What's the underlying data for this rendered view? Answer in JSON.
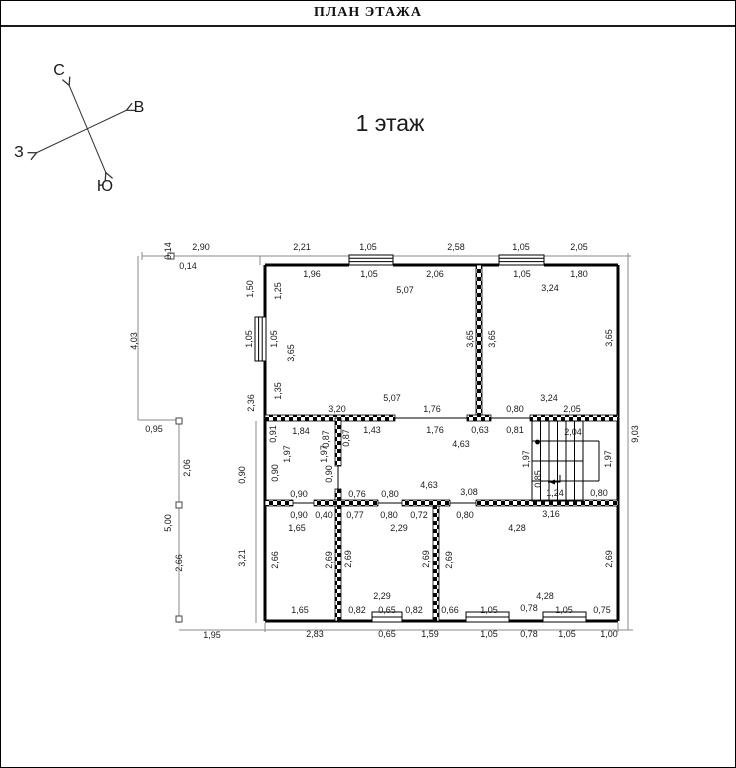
{
  "page": {
    "title": "ПЛАН ЭТАЖА",
    "floor_label": "1 этаж"
  },
  "compass": {
    "north": "С",
    "east": "В",
    "west": "З",
    "south": "Ю"
  },
  "colors": {
    "ink": "#000000",
    "dim_text": "#1a1a1a",
    "aux_line": "#888888"
  },
  "plan": {
    "units": "meters",
    "labels": [
      {
        "t": "2,90",
        "x": 200,
        "y": 246
      },
      {
        "t": "2,21",
        "x": 301,
        "y": 246
      },
      {
        "t": "1,05",
        "x": 367,
        "y": 246
      },
      {
        "t": "2,58",
        "x": 455,
        "y": 246
      },
      {
        "t": "1,05",
        "x": 520,
        "y": 246
      },
      {
        "t": "2,05",
        "x": 578,
        "y": 246
      },
      {
        "t": "0,14",
        "x": 167,
        "y": 250,
        "r": 1
      },
      {
        "t": "0,14",
        "x": 187,
        "y": 265
      },
      {
        "t": "1,96",
        "x": 311,
        "y": 273
      },
      {
        "t": "1,05",
        "x": 368,
        "y": 273
      },
      {
        "t": "2,06",
        "x": 434,
        "y": 273
      },
      {
        "t": "1,05",
        "x": 521,
        "y": 273
      },
      {
        "t": "1,80",
        "x": 578,
        "y": 273
      },
      {
        "t": "3,24",
        "x": 549,
        "y": 287
      },
      {
        "t": "5,07",
        "x": 404,
        "y": 289
      },
      {
        "t": "4,03",
        "x": 133,
        "y": 340,
        "r": 1
      },
      {
        "t": "1,50",
        "x": 249,
        "y": 288,
        "r": 1
      },
      {
        "t": "1,25",
        "x": 277,
        "y": 290,
        "r": 1
      },
      {
        "t": "1,05",
        "x": 248,
        "y": 338,
        "r": 1
      },
      {
        "t": "1,05",
        "x": 273,
        "y": 338,
        "r": 1
      },
      {
        "t": "3,65",
        "x": 290,
        "y": 352,
        "r": 1
      },
      {
        "t": "1,35",
        "x": 277,
        "y": 390,
        "r": 1
      },
      {
        "t": "2,36",
        "x": 250,
        "y": 402,
        "r": 1
      },
      {
        "t": "3,65",
        "x": 469,
        "y": 338,
        "r": 1
      },
      {
        "t": "3,65",
        "x": 491,
        "y": 338,
        "r": 1
      },
      {
        "t": "3,65",
        "x": 608,
        "y": 337,
        "r": 1
      },
      {
        "t": "0,95",
        "x": 153,
        "y": 428
      },
      {
        "t": "5,07",
        "x": 391,
        "y": 397
      },
      {
        "t": "3,24",
        "x": 548,
        "y": 397
      },
      {
        "t": "3,20",
        "x": 336,
        "y": 408
      },
      {
        "t": "1,76",
        "x": 431,
        "y": 408
      },
      {
        "t": "0,80",
        "x": 514,
        "y": 408
      },
      {
        "t": "2,05",
        "x": 571,
        "y": 408
      },
      {
        "t": "1,84",
        "x": 300,
        "y": 430
      },
      {
        "t": "1,43",
        "x": 371,
        "y": 429
      },
      {
        "t": "1,76",
        "x": 434,
        "y": 429
      },
      {
        "t": "0,63",
        "x": 479,
        "y": 429
      },
      {
        "t": "0,81",
        "x": 514,
        "y": 429
      },
      {
        "t": "2,04",
        "x": 572,
        "y": 431
      },
      {
        "t": "0,91",
        "x": 272,
        "y": 433,
        "r": 1
      },
      {
        "t": "0,87",
        "x": 325,
        "y": 438,
        "r": 1
      },
      {
        "t": "0,87",
        "x": 345,
        "y": 437,
        "r": 1
      },
      {
        "t": "1,97",
        "x": 286,
        "y": 453,
        "r": 1
      },
      {
        "t": "1,97",
        "x": 323,
        "y": 453,
        "r": 1
      },
      {
        "t": "4,63",
        "x": 460,
        "y": 443
      },
      {
        "t": "0,90",
        "x": 241,
        "y": 474,
        "r": 1
      },
      {
        "t": "0,90",
        "x": 274,
        "y": 472,
        "r": 1
      },
      {
        "t": "0,90",
        "x": 328,
        "y": 473,
        "r": 1
      },
      {
        "t": "1,97",
        "x": 525,
        "y": 458,
        "r": 1
      },
      {
        "t": "1,97",
        "x": 607,
        "y": 458,
        "r": 1
      },
      {
        "t": "0,85",
        "x": 537,
        "y": 478,
        "r": 1
      },
      {
        "t": "9,03",
        "x": 634,
        "y": 433,
        "r": 1
      },
      {
        "t": "2,06",
        "x": 186,
        "y": 467,
        "r": 1
      },
      {
        "t": "5,00",
        "x": 167,
        "y": 522,
        "r": 1
      },
      {
        "t": "2,66",
        "x": 178,
        "y": 562,
        "r": 1
      },
      {
        "t": "0,90",
        "x": 298,
        "y": 493
      },
      {
        "t": "0,76",
        "x": 356,
        "y": 493
      },
      {
        "t": "0,80",
        "x": 389,
        "y": 493
      },
      {
        "t": "4,63",
        "x": 428,
        "y": 484
      },
      {
        "t": "3,08",
        "x": 468,
        "y": 491
      },
      {
        "t": "1,24",
        "x": 554,
        "y": 492
      },
      {
        "t": "0,80",
        "x": 598,
        "y": 492
      },
      {
        "t": "0,90",
        "x": 298,
        "y": 514
      },
      {
        "t": "0,40",
        "x": 323,
        "y": 514
      },
      {
        "t": "0,77",
        "x": 354,
        "y": 514
      },
      {
        "t": "0,80",
        "x": 388,
        "y": 514
      },
      {
        "t": "0,72",
        "x": 418,
        "y": 514
      },
      {
        "t": "0,80",
        "x": 464,
        "y": 514
      },
      {
        "t": "3,16",
        "x": 550,
        "y": 513
      },
      {
        "t": "1,65",
        "x": 296,
        "y": 527
      },
      {
        "t": "2,29",
        "x": 398,
        "y": 527
      },
      {
        "t": "4,28",
        "x": 516,
        "y": 527
      },
      {
        "t": "3,21",
        "x": 241,
        "y": 557,
        "r": 1
      },
      {
        "t": "2,66",
        "x": 274,
        "y": 559,
        "r": 1
      },
      {
        "t": "2,69",
        "x": 328,
        "y": 559,
        "r": 1
      },
      {
        "t": "2,69",
        "x": 347,
        "y": 558,
        "r": 1
      },
      {
        "t": "2,69",
        "x": 425,
        "y": 558,
        "r": 1
      },
      {
        "t": "2,69",
        "x": 448,
        "y": 559,
        "r": 1
      },
      {
        "t": "2,69",
        "x": 608,
        "y": 558,
        "r": 1
      },
      {
        "t": "2,29",
        "x": 381,
        "y": 595
      },
      {
        "t": "4,28",
        "x": 544,
        "y": 595
      },
      {
        "t": "1,65",
        "x": 299,
        "y": 609
      },
      {
        "t": "0,82",
        "x": 356,
        "y": 609
      },
      {
        "t": "0,65",
        "x": 386,
        "y": 609
      },
      {
        "t": "0,82",
        "x": 413,
        "y": 609
      },
      {
        "t": "0,66",
        "x": 449,
        "y": 609
      },
      {
        "t": "1,05",
        "x": 488,
        "y": 609
      },
      {
        "t": "0,78",
        "x": 528,
        "y": 607
      },
      {
        "t": "1,05",
        "x": 563,
        "y": 609
      },
      {
        "t": "0,75",
        "x": 601,
        "y": 609
      },
      {
        "t": "1,95",
        "x": 211,
        "y": 634
      },
      {
        "t": "2,83",
        "x": 314,
        "y": 633
      },
      {
        "t": "0,65",
        "x": 386,
        "y": 633
      },
      {
        "t": "1,59",
        "x": 429,
        "y": 633
      },
      {
        "t": "1,05",
        "x": 488,
        "y": 633
      },
      {
        "t": "0,78",
        "x": 528,
        "y": 633
      },
      {
        "t": "1,05",
        "x": 566,
        "y": 633
      },
      {
        "t": "1,00",
        "x": 608,
        "y": 633
      }
    ]
  }
}
